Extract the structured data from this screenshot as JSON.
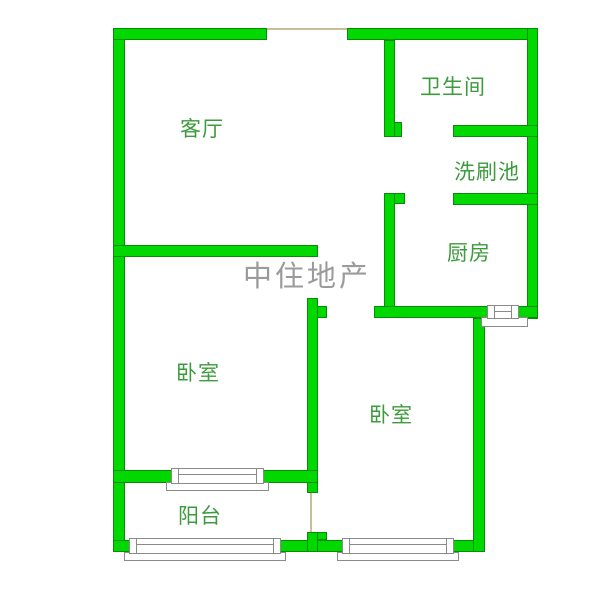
{
  "floorplan": {
    "watermark": "中住地产",
    "rooms": {
      "living_room": "客厅",
      "bathroom": "卫生间",
      "wash_area": "洗刷池",
      "kitchen": "厨房",
      "bedroom_left": "卧室",
      "bedroom_right": "卧室",
      "balcony": "阳台"
    },
    "symbols": {
      "window": "double-line-window-symbol",
      "door_opening": "tan-threshold-line"
    },
    "colors": {
      "wall_fill": "#00d800",
      "wall_edge": "#0a8a0a",
      "label_text": "#3c9b3c",
      "watermark_text": "#9b9b9b",
      "threshold_line": "#c9bf97",
      "window_edge": "#8a8a8a",
      "background": "#ffffff"
    }
  }
}
